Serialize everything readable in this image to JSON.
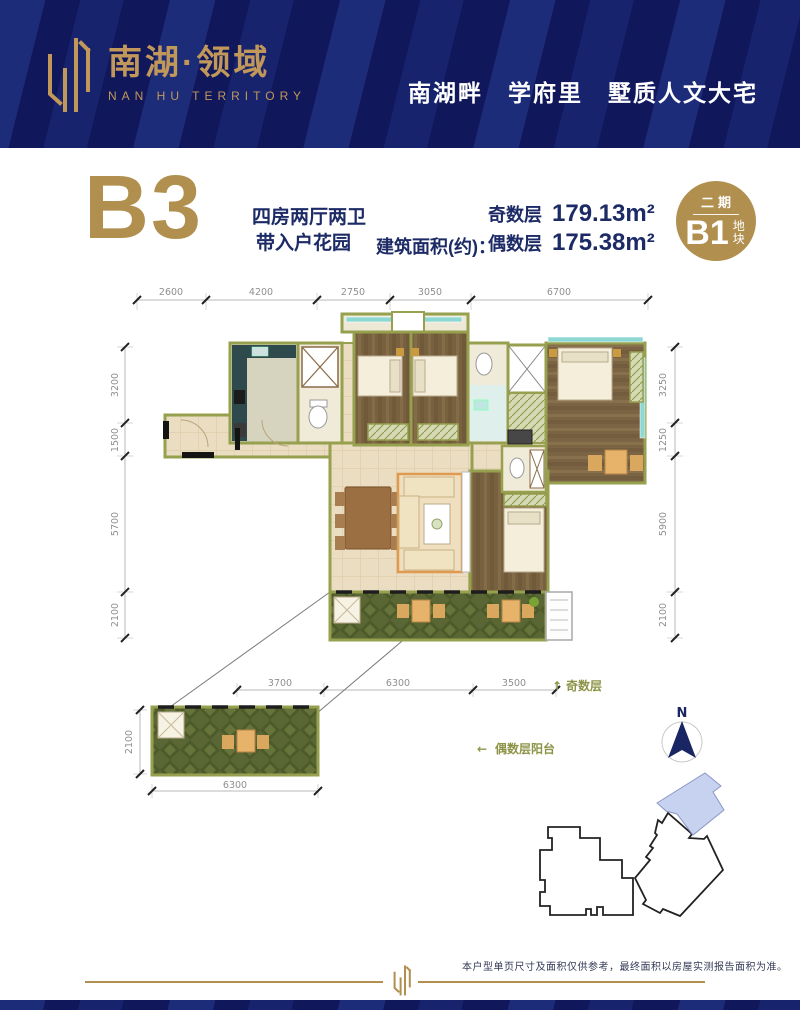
{
  "header": {
    "brand_cn": "南湖·领域",
    "brand_en": "NAN HU TERRITORY",
    "tagline": "南湖畔　学府里　墅质人文大宅"
  },
  "unit": {
    "code": "B3",
    "layout_line1": "四房两厅两卫",
    "layout_line2": "带入户花园",
    "area_label": "建筑面积(约)：",
    "floors": [
      {
        "label": "奇数层",
        "value": "179.13m²"
      },
      {
        "label": "偶数层",
        "value": "175.38m²"
      }
    ]
  },
  "badge": {
    "phase": "二期",
    "code": "B1",
    "suffix": "地块"
  },
  "dims": {
    "top": [
      "2600",
      "4200",
      "2750",
      "3050",
      "6700"
    ],
    "left": [
      "3200",
      "1500",
      "5700",
      "2100"
    ],
    "right": [
      "3250",
      "1250",
      "5900",
      "2100"
    ],
    "bottom": [
      "3700",
      "6300",
      "3500"
    ],
    "detail_height": "2100",
    "detail_width": "6300"
  },
  "annotations": {
    "odd_arrow": "↑",
    "odd_label": "奇数层",
    "even_arrow": "←",
    "even_label": "偶数层阳台",
    "compass": "N"
  },
  "footer": {
    "disclaimer": "本户型单页尺寸及面积仅供参考，最终面积以房屋实测报告面积为准。"
  },
  "colors": {
    "navy": "#10175a",
    "gold": "#b1904f",
    "wall_olive": "#96a04e",
    "highlight_blue": "#c7d2f1"
  }
}
